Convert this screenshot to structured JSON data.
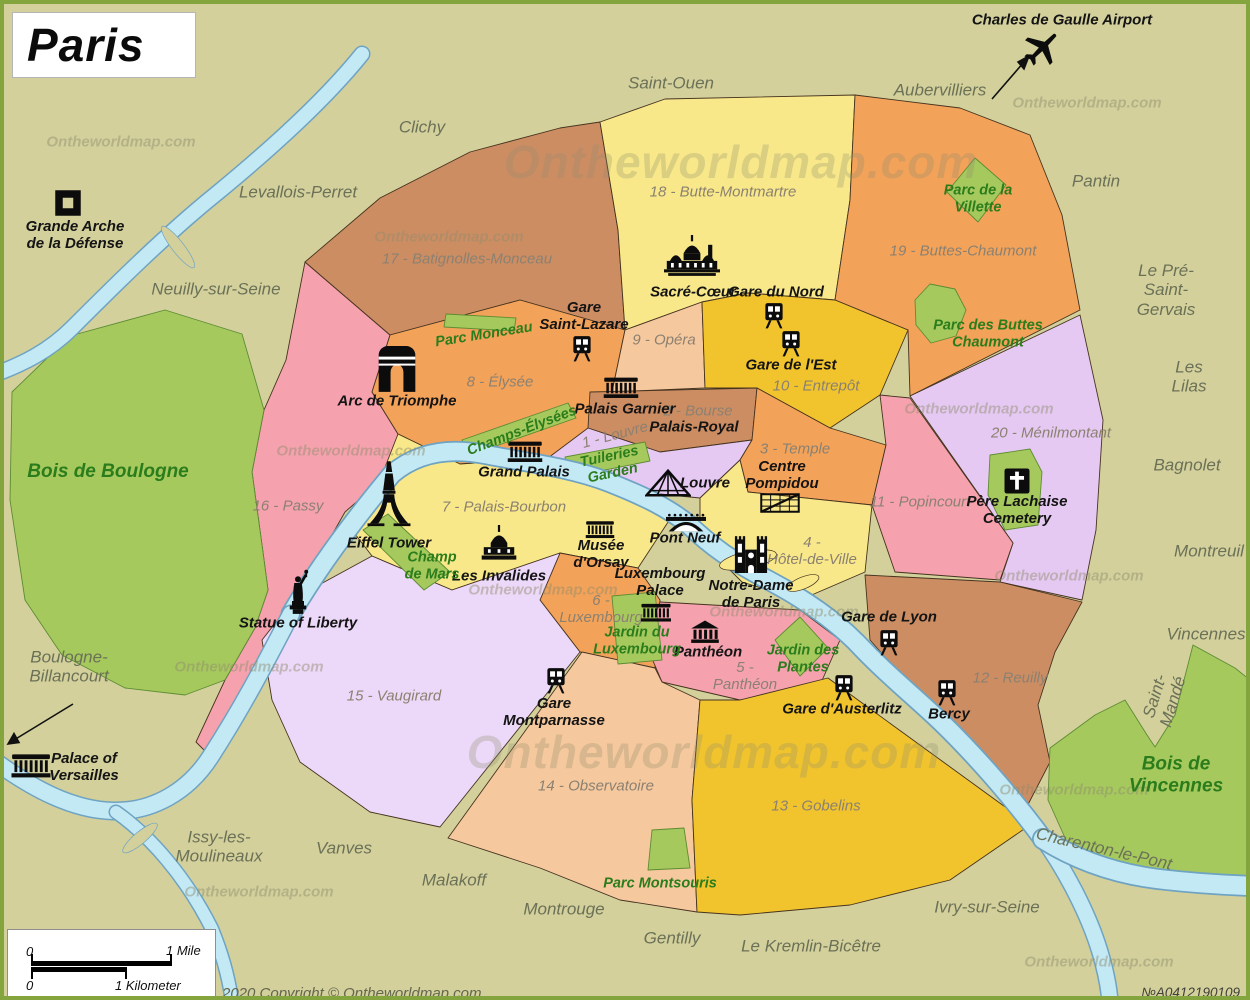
{
  "title": "Paris",
  "watermark": "Ontheworldmap.com",
  "copyright": "2020 Copyright © Ontheworldmap.com",
  "map_id": "№A0412190109",
  "scale": {
    "mile_zero": "0",
    "mile": "1 Mile",
    "km_zero": "0",
    "km": "1 Kilometer"
  },
  "colors": {
    "background": "#d3d09c",
    "frame": "#84a53e",
    "water": "#c3e9f5",
    "water_edge": "#6fa3c2",
    "park": "#a6c95e",
    "park_edge": "#5d8c33",
    "line": "#46331f",
    "island": "#f8e88a",
    "title_text": "#0b0b0b",
    "suburb_text": "#6b7157",
    "district_text": "#8b8171",
    "landmark_text": "#141414",
    "park_text": "#2b7d1c",
    "watermark_text": "#8e8c6c",
    "d_sienna": "#cd8d63",
    "d_orange": "#f3a259",
    "d_gold": "#f1c42e",
    "d_yellow": "#f8e88a",
    "d_peach": "#f6c89e",
    "d_pink": "#f5a2ae",
    "d_lavender": "#e5c9f3",
    "d_lavender_light": "#ecd8f8"
  },
  "districts": {
    "d1": "1 - Louvre",
    "d2": "2 - Bourse",
    "d3": "3 - Temple",
    "d4": "4 -\nHôtel-de-Ville",
    "d5": "5 -\nPanthéon",
    "d6": "6 -\nLuxembourg",
    "d7": "7 - Palais-Bourbon",
    "d8": "8 - Élysée",
    "d9": "9 - Opéra",
    "d10": "10 - Entrepôt",
    "d11": "11 - Popincourt",
    "d12": "12 - Reuilly",
    "d13": "13 - Gobelins",
    "d14": "14 - Observatoire",
    "d15": "15 - Vaugirard",
    "d16": "16 - Passy",
    "d17": "17 - Batignolles-Monceau",
    "d18": "18 - Butte-Montmartre",
    "d19": "19 - Buttes-Chaumont",
    "d20": "20 - Ménilmontant"
  },
  "suburbs": {
    "saint_ouen": "Saint-Ouen",
    "clichy": "Clichy",
    "levallois": "Levallois-Perret",
    "neuilly": "Neuilly-sur-Seine",
    "aubervilliers": "Aubervilliers",
    "pantin": "Pantin",
    "pre_saint_gervais": "Le Pré-Saint-Gervais",
    "les_lilas": "Les Lilas",
    "bagnolet": "Bagnolet",
    "montreuil": "Montreuil",
    "vincennes": "Vincennes",
    "saint_mande": "Saint-Mandé",
    "boulogne_billancourt": "Boulogne-\nBillancourt",
    "issy": "Issy-les-\nMoulineaux",
    "vanves": "Vanves",
    "malakoff": "Malakoff",
    "montrouge": "Montrouge",
    "gentilly": "Gentilly",
    "kremlin": "Le Kremlin-Bicêtre",
    "ivry": "Ivry-sur-Seine",
    "charenton": "Charenton-le-Pont"
  },
  "landmarks": {
    "grande_arche": "Grande Arche\nde la Défense",
    "cdg_airport": "Charles de Gaulle Airport",
    "sacre_coeur": "Sacré-Cœur",
    "gare_du_nord": "Gare du Nord",
    "gare_saint_lazare": "Gare\nSaint-Lazare",
    "gare_de_l_est": "Gare de l'Est",
    "palais_garnier": "Palais Garnier",
    "palais_royal": "Palais-Royal",
    "arc_de_triomphe": "Arc de Triomphe",
    "grand_palais": "Grand Palais",
    "louvre": "Louvre",
    "centre_pompidou": "Centre\nPompidou",
    "pont_neuf": "Pont Neuf",
    "notre_dame": "Notre-Dame\nde Paris",
    "eiffel_tower": "Eiffel Tower",
    "les_invalides": "Les Invalides",
    "musee_orsay": "Musée\nd'Orsay",
    "luxembourg_palace": "Luxembourg\nPalace",
    "pantheon": "Panthéon",
    "statue_of_liberty": "Statue of Liberty",
    "gare_montparnasse": "Gare\nMontparnasse",
    "gare_de_lyon": "Gare de Lyon",
    "gare_austerlitz": "Gare d'Austerlitz",
    "bercy": "Bercy",
    "pere_lachaise": "Père Lachaise\nCemetery",
    "versailles": "Palace of\nVersailles"
  },
  "parks": {
    "monceau": "Parc Monceau",
    "champs_elysees": "Champs-Élysées",
    "tuileries": "Tuileries\nGarden",
    "champ_de_mars": "Champ\nde Mars",
    "jardin_luxembourg": "Jardin du\nLuxembourg",
    "jardin_plantes": "Jardin des\nPlantes",
    "montsouris": "Parc Montsouris",
    "villette": "Parc de la\nVillette",
    "buttes_chaumont_parc": "Parc des Buttes\nChaumont",
    "bois_boulogne": "Bois de Boulogne",
    "bois_vincennes": "Bois de Vincennes"
  }
}
